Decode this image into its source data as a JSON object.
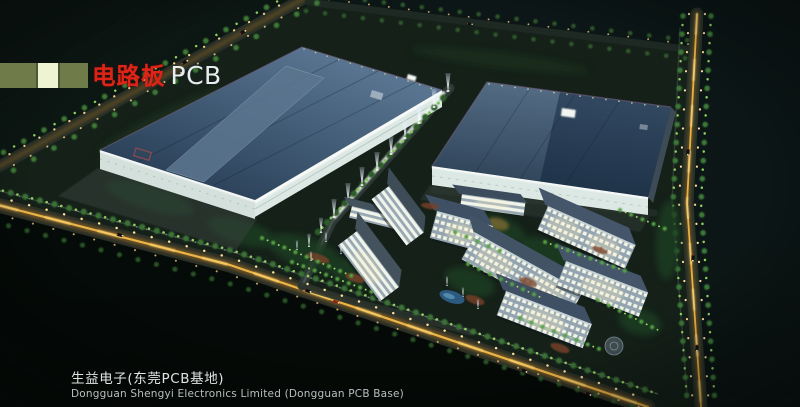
{
  "artwork": {
    "kind": "night aerial architectural rendering",
    "subject": "PCB factory campus with two large plants, light-beam axis, dormitory cluster and perimeter roads"
  },
  "header": {
    "category_cn": "电路板",
    "category_en": "PCB",
    "bar_segment_colors": [
      "#6f7c49",
      "#eef3d2",
      "#6f7c49"
    ],
    "title_red": "#de2417",
    "title_white": "#e9edef"
  },
  "caption": {
    "cn": "生益电子(东莞PCB基地)",
    "en": "Dongguan Shengyi Electronics Limited (Dongguan PCB Base)"
  },
  "palette": {
    "background_dark": "#0b1411",
    "factory_roof_blue": "#3b5570",
    "lit_facade_white": "#e9f2ef",
    "road_glow_amber": "#e8a83c",
    "street_lamp": "#ffdf9a",
    "tree_green": "#3e7a36",
    "tree_highlight": "#8fd25e",
    "dorm_window_warm": "#f4f0d8",
    "pool_blue": "#2f608a"
  }
}
